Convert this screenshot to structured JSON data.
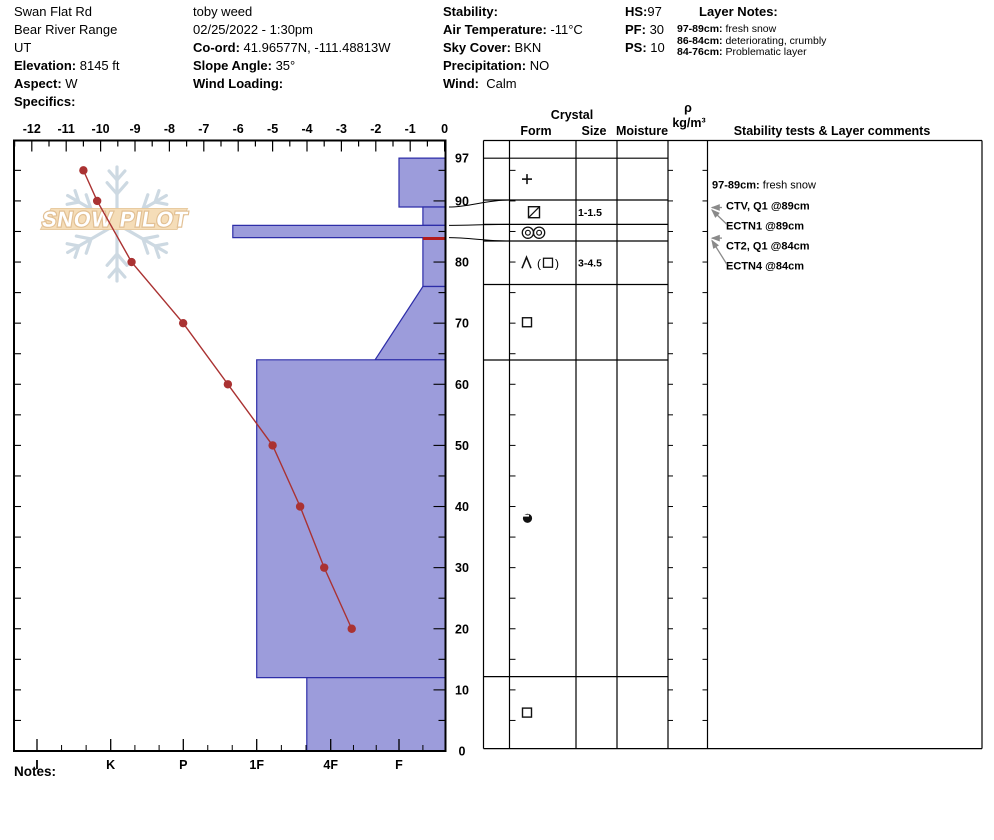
{
  "header": {
    "site": {
      "lines": [
        {
          "b": "",
          "t": "Swan Flat Rd"
        },
        {
          "b": "",
          "t": "Bear River Range"
        },
        {
          "b": "",
          "t": "UT"
        },
        {
          "b": "Elevation:",
          "t": " 8145 ft"
        },
        {
          "b": "Aspect:",
          "t": " W"
        },
        {
          "b": "Specifics:",
          "t": ""
        }
      ]
    },
    "observer": {
      "lines": [
        {
          "b": "",
          "t": "toby weed"
        },
        {
          "b": "",
          "t": "02/25/2022 - 1:30pm"
        },
        {
          "b": "Co-ord:",
          "t": " 41.96577N, -111.48813W"
        },
        {
          "b": "Slope Angle:",
          "t": " 35°"
        },
        {
          "b": "Wind Loading:",
          "t": ""
        }
      ]
    },
    "weather": {
      "lines": [
        {
          "b": "Stability:",
          "t": ""
        },
        {
          "b": "Air Temperature:",
          "t": " -11°C"
        },
        {
          "b": "Sky Cover:",
          "t": " BKN"
        },
        {
          "b": "Precipitation:",
          "t": " NO"
        },
        {
          "b": "Wind:",
          "t": "  Calm"
        }
      ]
    },
    "snowpack": {
      "lines": [
        {
          "b": "HS:",
          "t": "97"
        },
        {
          "b": "PF:",
          "t": " 30"
        },
        {
          "b": "PS:",
          "t": " 10"
        }
      ]
    },
    "layer_notes": {
      "title": "Layer Notes:",
      "items": [
        {
          "b": "97-89cm:",
          "t": " fresh snow"
        },
        {
          "b": "86-84cm:",
          "t": " deteriorating, crumbly"
        },
        {
          "b": "84-76cm:",
          "t": " Problematic layer"
        }
      ]
    }
  },
  "watermark": {
    "text": "SNOW PILOT"
  },
  "notes_label": "Notes:",
  "chart_data": {
    "type": "snow-profile",
    "title": "",
    "temp_axis": {
      "unit": "°C",
      "min": -12,
      "max": 0,
      "major_tick": 1,
      "minor_tick": 0.5,
      "tick_labels": [
        "-12",
        "-11",
        "-10",
        "-9",
        "-8",
        "-7",
        "-6",
        "-5",
        "-4",
        "-3",
        "-2",
        "-1",
        "0"
      ]
    },
    "depth_axis": {
      "unit": "cm",
      "total_height_cm": 97,
      "tick_labels": [
        97,
        90,
        80,
        70,
        60,
        50,
        40,
        30,
        20,
        10,
        0
      ]
    },
    "hardness_axis": {
      "categories": [
        "I",
        "K",
        "P",
        "1F",
        "4F",
        "F"
      ]
    },
    "temperature_profile": [
      {
        "depth_cm": 95,
        "temp_c": -10.5
      },
      {
        "depth_cm": 90,
        "temp_c": -10.1
      },
      {
        "depth_cm": 80,
        "temp_c": -9.1
      },
      {
        "depth_cm": 70,
        "temp_c": -7.6
      },
      {
        "depth_cm": 60,
        "temp_c": -6.3
      },
      {
        "depth_cm": 50,
        "temp_c": -5.0
      },
      {
        "depth_cm": 40,
        "temp_c": -4.2
      },
      {
        "depth_cm": 30,
        "temp_c": -3.5
      },
      {
        "depth_cm": 20,
        "temp_c": -2.7
      }
    ],
    "layers": [
      {
        "top_cm": 97,
        "bottom_cm": 89,
        "hardness": "F",
        "grain_form_symbol": "plus",
        "grain_size_mm": ""
      },
      {
        "top_cm": 89,
        "bottom_cm": 86,
        "hardness": "F-",
        "grain_form_symbol": "square-slash",
        "grain_size_mm": "1-1.5"
      },
      {
        "top_cm": 86,
        "bottom_cm": 84,
        "hardness": "1F+",
        "grain_form_symbol": "double-bullseye",
        "grain_size_mm": ""
      },
      {
        "top_cm": 84,
        "bottom_cm": 76,
        "hardness": "F-",
        "grain_form_symbol": "lambda-paren-square",
        "grain_size_mm": "3-4.5",
        "flagged_red_top": true
      },
      {
        "top_cm": 76,
        "bottom_cm": 64,
        "hardness_top": "F-",
        "hardness_bottom": "F+",
        "grain_form_symbol": "square",
        "grain_size_mm": ""
      },
      {
        "top_cm": 64,
        "bottom_cm": 12,
        "hardness": "1F",
        "grain_form_symbol": "circle-notch",
        "grain_size_mm": ""
      },
      {
        "top_cm": 12,
        "bottom_cm": 0,
        "hardness": "4F+",
        "grain_form_symbol": "square",
        "grain_size_mm": ""
      }
    ],
    "table_headers": {
      "crystal": "Crystal",
      "form": "Form",
      "size": "Size",
      "moisture": "Moisture",
      "density_rho": "ρ",
      "density_unit": "kg/m³",
      "stability": "Stability tests & Layer comments"
    },
    "stability_tests": [
      {
        "text": "CTV, Q1 @89cm",
        "target_depth_cm": 89
      },
      {
        "text": "ECTN1 @89cm",
        "target_depth_cm": 89
      },
      {
        "text": "CT2, Q1 @84cm",
        "target_depth_cm": 84
      },
      {
        "text": "ECTN4 @84cm",
        "target_depth_cm": 84
      }
    ],
    "layer_comment": {
      "range": "97-89cm:",
      "text": "fresh snow"
    },
    "colors": {
      "layer_fill": "#9c9cdb",
      "layer_border": "#2d2da8",
      "temp_line": "#aa3232",
      "flag_red": "#b31b1b"
    }
  }
}
